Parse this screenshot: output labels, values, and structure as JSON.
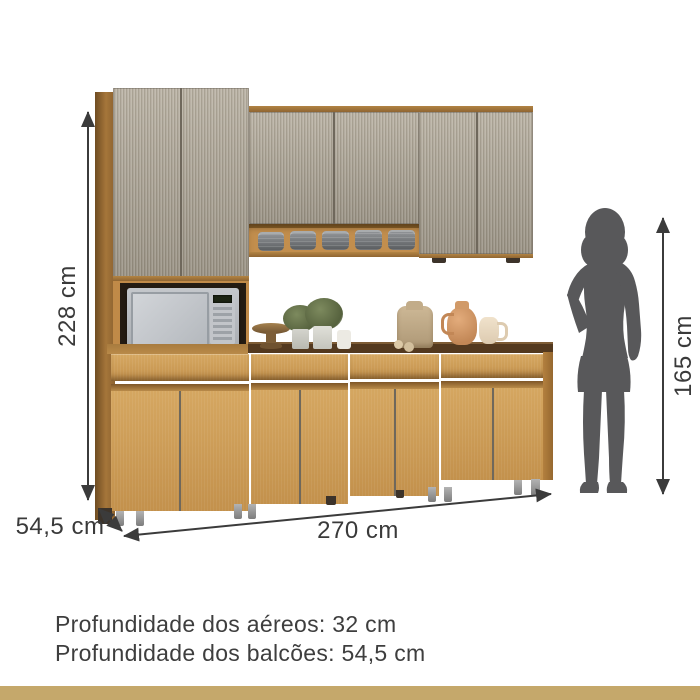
{
  "dimensions": {
    "height_label": "228 cm",
    "depth_label": "54,5 cm",
    "width_label": "270 cm",
    "person_height_label": "165 cm"
  },
  "footer": {
    "line1": "Profundidade dos aéreos: 32 cm",
    "line2": "Profundidade dos balcões: 54,5 cm",
    "bar_color": "#c5a86b"
  },
  "colors": {
    "background": "#ffffff",
    "wood_oak": "#cb9c57",
    "wood_side_dark": "#8d6330",
    "fluted_door": "#b3ab9d",
    "counter_edge": "#53391f",
    "arrow": "#3b3b3b",
    "silhouette": "#58585a",
    "text": "#3e3e3e",
    "footer_bar": "#c5a86b"
  },
  "icons": [
    "up-down-arrow-icon",
    "diagonal-depth-arrow-icon",
    "left-right-arrow-icon",
    "person-silhouette-icon"
  ],
  "illustration": {
    "items": [
      "kitchen-cabinet-set",
      "tall-cabinet-fluted-doors",
      "wall-cabinet-fluted-doors",
      "open-shelf-with-stacked-bowls",
      "microwave-in-niche",
      "base-cabinets-with-drawers",
      "pedestal-bowl",
      "potted-plants",
      "small-jar",
      "burlap-sack",
      "clay-jug",
      "cream-pitcher",
      "person-silhouette"
    ]
  }
}
